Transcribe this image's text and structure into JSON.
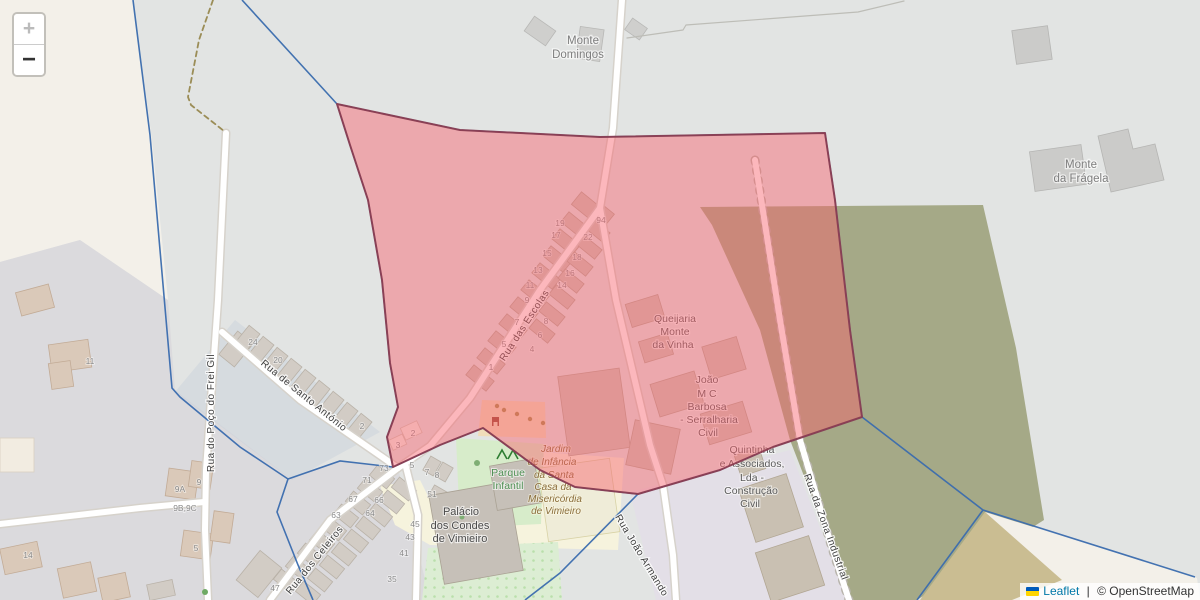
{
  "controls": {
    "zoom_in": "+",
    "zoom_out": "−"
  },
  "attribution": {
    "leaflet": "Leaflet",
    "separator": " | ",
    "osm": "© OpenStreetMap"
  },
  "colors": {
    "overlay_fill": "#f85f6a",
    "overlay_stroke": "#8c3b4e",
    "admin_boundary": "#3a6cae",
    "farmland": "#a5a987",
    "farmland_tan": "#cabd92",
    "park_green": "#d7ecca",
    "school_yellow": "#f6f3dd"
  },
  "places": {
    "monte_domingos": [
      "Monte",
      "Domingos"
    ],
    "monte_fragela": [
      "Monte",
      "da Frágela"
    ]
  },
  "pois": {
    "queijaria": [
      "Queijaria",
      "Monte",
      "da Vinha"
    ],
    "joao": [
      "João",
      "M C",
      "Barbosa",
      "- Serralharia",
      "Civil"
    ],
    "quintinha": [
      "Quintinha",
      "e Associados,",
      "Lda -",
      "Construção",
      "Civil"
    ],
    "palacio": [
      "Palácio",
      "dos Condes",
      "de Vimieiro"
    ],
    "parque": [
      "Parque",
      "Infantil"
    ],
    "jardim": [
      "Jardim",
      "de Infância",
      "da Santa",
      "Casa da",
      "Misericórdia",
      "de Vimieiro"
    ]
  },
  "streets": {
    "escolas": "Rua das Escolas",
    "frei_gil": "Rua do Poço do Frei Gil",
    "santo_antonio": "Rua de Santo António",
    "celeiros": "Rua dos Celeiros",
    "joao_armando": "Rua João Armando",
    "zona_industrial": "Rua da Zona Industrial"
  },
  "house_numbers": [
    {
      "t": "19",
      "x": 560,
      "y": 226
    },
    {
      "t": "17",
      "x": 556,
      "y": 238
    },
    {
      "t": "15",
      "x": 547,
      "y": 256
    },
    {
      "t": "13",
      "x": 538,
      "y": 273
    },
    {
      "t": "11",
      "x": 530,
      "y": 288
    },
    {
      "t": "9",
      "x": 527,
      "y": 303
    },
    {
      "t": "7",
      "x": 517,
      "y": 325
    },
    {
      "t": "5",
      "x": 504,
      "y": 347
    },
    {
      "t": "1",
      "x": 491,
      "y": 370
    },
    {
      "t": "94",
      "x": 601,
      "y": 223
    },
    {
      "t": "22",
      "x": 588,
      "y": 240
    },
    {
      "t": "18",
      "x": 577,
      "y": 260
    },
    {
      "t": "16",
      "x": 570,
      "y": 276
    },
    {
      "t": "14",
      "x": 562,
      "y": 288
    },
    {
      "t": "8",
      "x": 546,
      "y": 324
    },
    {
      "t": "6",
      "x": 540,
      "y": 338
    },
    {
      "t": "4",
      "x": 532,
      "y": 352
    },
    {
      "t": "2",
      "x": 413,
      "y": 436
    },
    {
      "t": "3",
      "x": 398,
      "y": 448
    },
    {
      "t": "24",
      "x": 253,
      "y": 345
    },
    {
      "t": "20",
      "x": 278,
      "y": 363
    },
    {
      "t": "2",
      "x": 362,
      "y": 429
    },
    {
      "t": "11",
      "x": 90,
      "y": 364
    },
    {
      "t": "14",
      "x": 28,
      "y": 558
    },
    {
      "t": "9",
      "x": 199,
      "y": 485
    },
    {
      "t": "9A",
      "x": 180,
      "y": 492
    },
    {
      "t": "9B,9C",
      "x": 185,
      "y": 511
    },
    {
      "t": "5",
      "x": 196,
      "y": 551
    },
    {
      "t": "73",
      "x": 384,
      "y": 471
    },
    {
      "t": "71",
      "x": 367,
      "y": 483
    },
    {
      "t": "67",
      "x": 353,
      "y": 502
    },
    {
      "t": "66",
      "x": 379,
      "y": 503
    },
    {
      "t": "63",
      "x": 336,
      "y": 518
    },
    {
      "t": "64",
      "x": 370,
      "y": 516
    },
    {
      "t": "47",
      "x": 275,
      "y": 591
    },
    {
      "t": "51",
      "x": 432,
      "y": 497
    },
    {
      "t": "45",
      "x": 415,
      "y": 527
    },
    {
      "t": "43",
      "x": 410,
      "y": 540
    },
    {
      "t": "41",
      "x": 404,
      "y": 556
    },
    {
      "t": "35",
      "x": 392,
      "y": 582
    },
    {
      "t": "5",
      "x": 412,
      "y": 468
    },
    {
      "t": "7",
      "x": 427,
      "y": 475
    },
    {
      "t": "8",
      "x": 437,
      "y": 478
    }
  ]
}
